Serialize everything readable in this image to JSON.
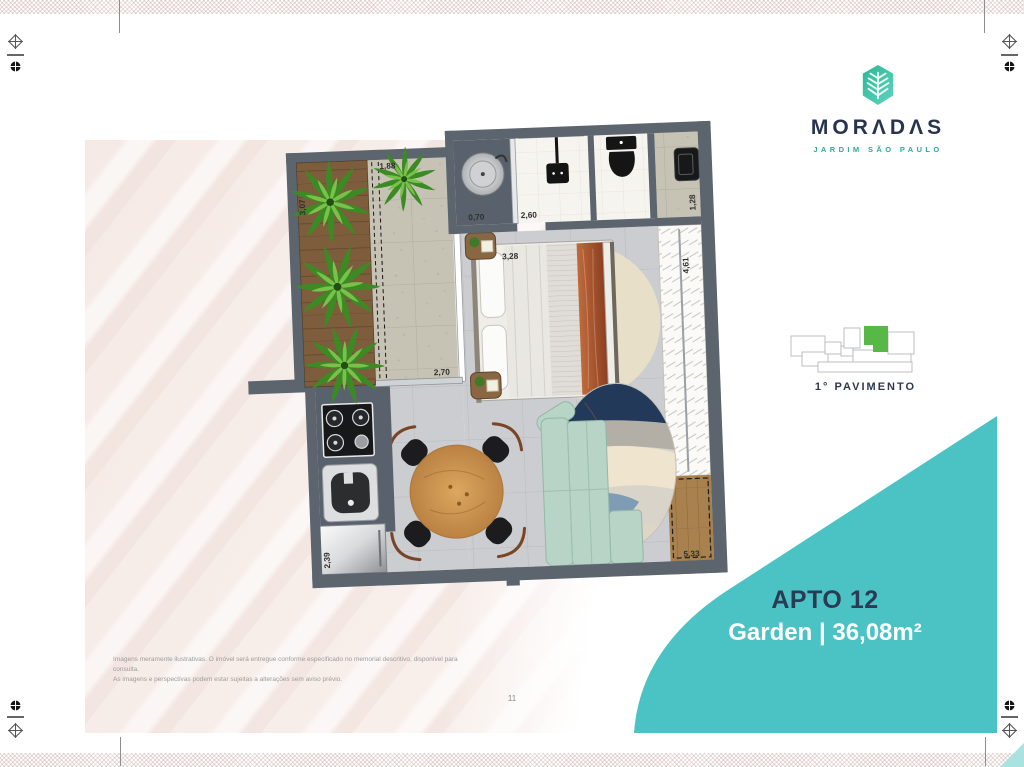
{
  "brand": {
    "display": "MORΛDΛS",
    "name": "MORADAS",
    "subtitle": "JARDIM SÃO PAULO",
    "logo_icon": "leaf-hexagon-icon"
  },
  "keyplan": {
    "label": "1° PAVIMENTO",
    "highlight_color": "#58b847"
  },
  "unit": {
    "title": "APTO 12",
    "subtitle": "Garden | 36,08m²"
  },
  "floorplan": {
    "dims": {
      "garden_width": "1,88",
      "garden_height": "3,07",
      "laundry": "0,70",
      "bath": "2,60",
      "entry": "1,28",
      "bedroom": "3,28",
      "garden_door": "2,70",
      "closet": "4,61",
      "kitchen": "2,39",
      "terrace": "5,33"
    }
  },
  "footer": {
    "disclaimer_line1": "Imagens meramente ilustrativas. O imóvel será entregue conforme especificado no memorial descritivo, disponível para consulta.",
    "disclaimer_line2": "As imagens e perspectivas podem estar sujeitas a alterações sem aviso prévio.",
    "page_number": "11"
  },
  "colors": {
    "teal_panel": "#4bc3c4",
    "navy": "#2b3a55",
    "brand_teal": "#2fa8a3",
    "wall_gray": "#5c646e"
  }
}
